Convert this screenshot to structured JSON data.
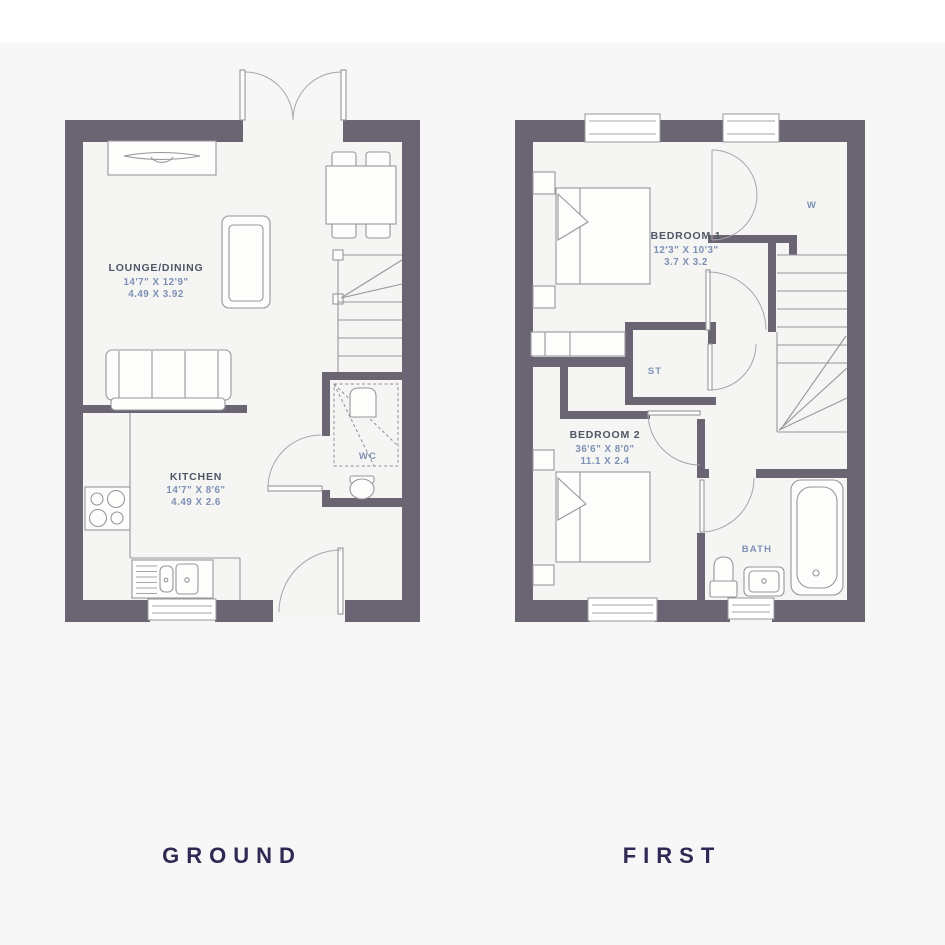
{
  "titles": {
    "ground": "GROUND",
    "first": "FIRST"
  },
  "ground": {
    "lounge": {
      "name": "LOUNGE/DINING",
      "imperial": "14'7\" X 12'9\"",
      "metric": "4.49 X 3.92"
    },
    "kitchen": {
      "name": "KITCHEN",
      "imperial": "14'7\" X 8'6\"",
      "metric": "4.49 X 2.6"
    },
    "wc": {
      "name": "WC"
    }
  },
  "first": {
    "bedroom1": {
      "name": "BEDROOM 1",
      "imperial": "12'3\" X 10'3\"",
      "metric": "3.7 X 3.2"
    },
    "bedroom2": {
      "name": "BEDROOM 2",
      "imperial": "36'6\" X 8'0\"",
      "metric": "11.1 X 2.4"
    },
    "store": {
      "name": "ST"
    },
    "bath": {
      "name": "BATH"
    },
    "wardrobe": {
      "name": "W"
    }
  },
  "colors": {
    "wall": "#6b6472",
    "floor": "#f5f5f4",
    "background": "#f7f7f7",
    "top_strip": "#ffffff",
    "room_name_text": "#4e5565",
    "dimension_text": "#7e90b4",
    "title_text": "#2e2a54",
    "furniture_stroke": "#97979c"
  }
}
